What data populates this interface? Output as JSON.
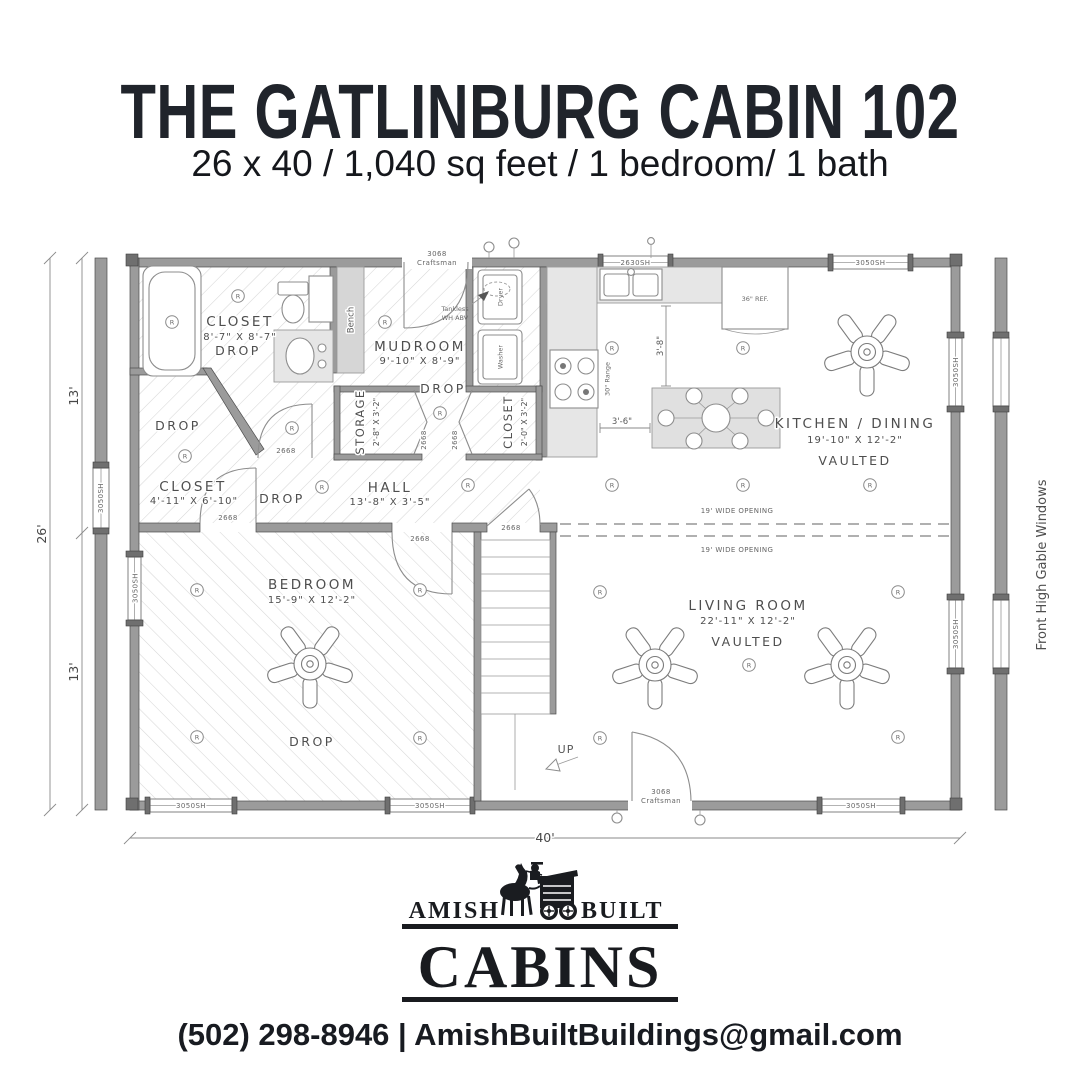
{
  "header": {
    "title": "THE GATLINBURG CABIN 102",
    "subtitle": "26 x 40 / 1,040 sq feet / 1 bedroom/ 1 bath"
  },
  "plan": {
    "dimensions": {
      "width": "40'",
      "depth": "26'",
      "half_top": "13'",
      "half_bottom": "13'"
    },
    "gable_note": "Front High Gable Windows",
    "rooms": {
      "bath": {
        "name": "CLOSET",
        "size": "8'-7\" X 8'-7\"",
        "note": "DROP"
      },
      "closet_rear": {
        "name": "CLOSET",
        "size": "4'-11\" X 6'-10\""
      },
      "hall": {
        "name": "HALL",
        "size": "13'-8\" X 3'-5\""
      },
      "mudroom": {
        "name": "MUDROOM",
        "size": "9'-10\" X 8'-9\"",
        "note": "DROP"
      },
      "storage": {
        "name": "STORAGE",
        "size": "2'-8\" X 3'-2\""
      },
      "wd_closet": {
        "name": "CLOSET",
        "size": "2'-0\" X 3'-2\""
      },
      "kitchen": {
        "name": "KITCHEN / DINING",
        "size": "19'-10\" X 12'-2\"",
        "note": "VAULTED"
      },
      "living": {
        "name": "LIVING ROOM",
        "size": "22'-11\" X 12'-2\"",
        "note": "VAULTED"
      },
      "bedroom": {
        "name": "BEDROOM",
        "size": "15'-9\" X 12'-2\"",
        "note": "DROP"
      }
    },
    "labels": {
      "drop": "DROP",
      "bench": "Bench",
      "tankless_line1": "Tankless",
      "tankless_line2": "WH ABV",
      "dryer": "Dryer",
      "washer": "Washer",
      "fridge": "36\" REF.",
      "range": "30\" Range",
      "up": "UP",
      "wide_opening": "19' WIDE OPENING",
      "door_num": "3068",
      "door_type": "Craftsman",
      "door_2668": "2668",
      "window_3050": "3050SH",
      "window_2630": "2630SH",
      "dim_3_8": "3'-8\"",
      "dim_3_6": "3'-6\"",
      "recessed": "R"
    }
  },
  "logo": {
    "word_left": "AMISH",
    "word_right": "BUILT",
    "word_main": "CABINS"
  },
  "footer": {
    "contact": "(502) 298-8946 | AmishBuiltBuildings@gmail.com"
  }
}
